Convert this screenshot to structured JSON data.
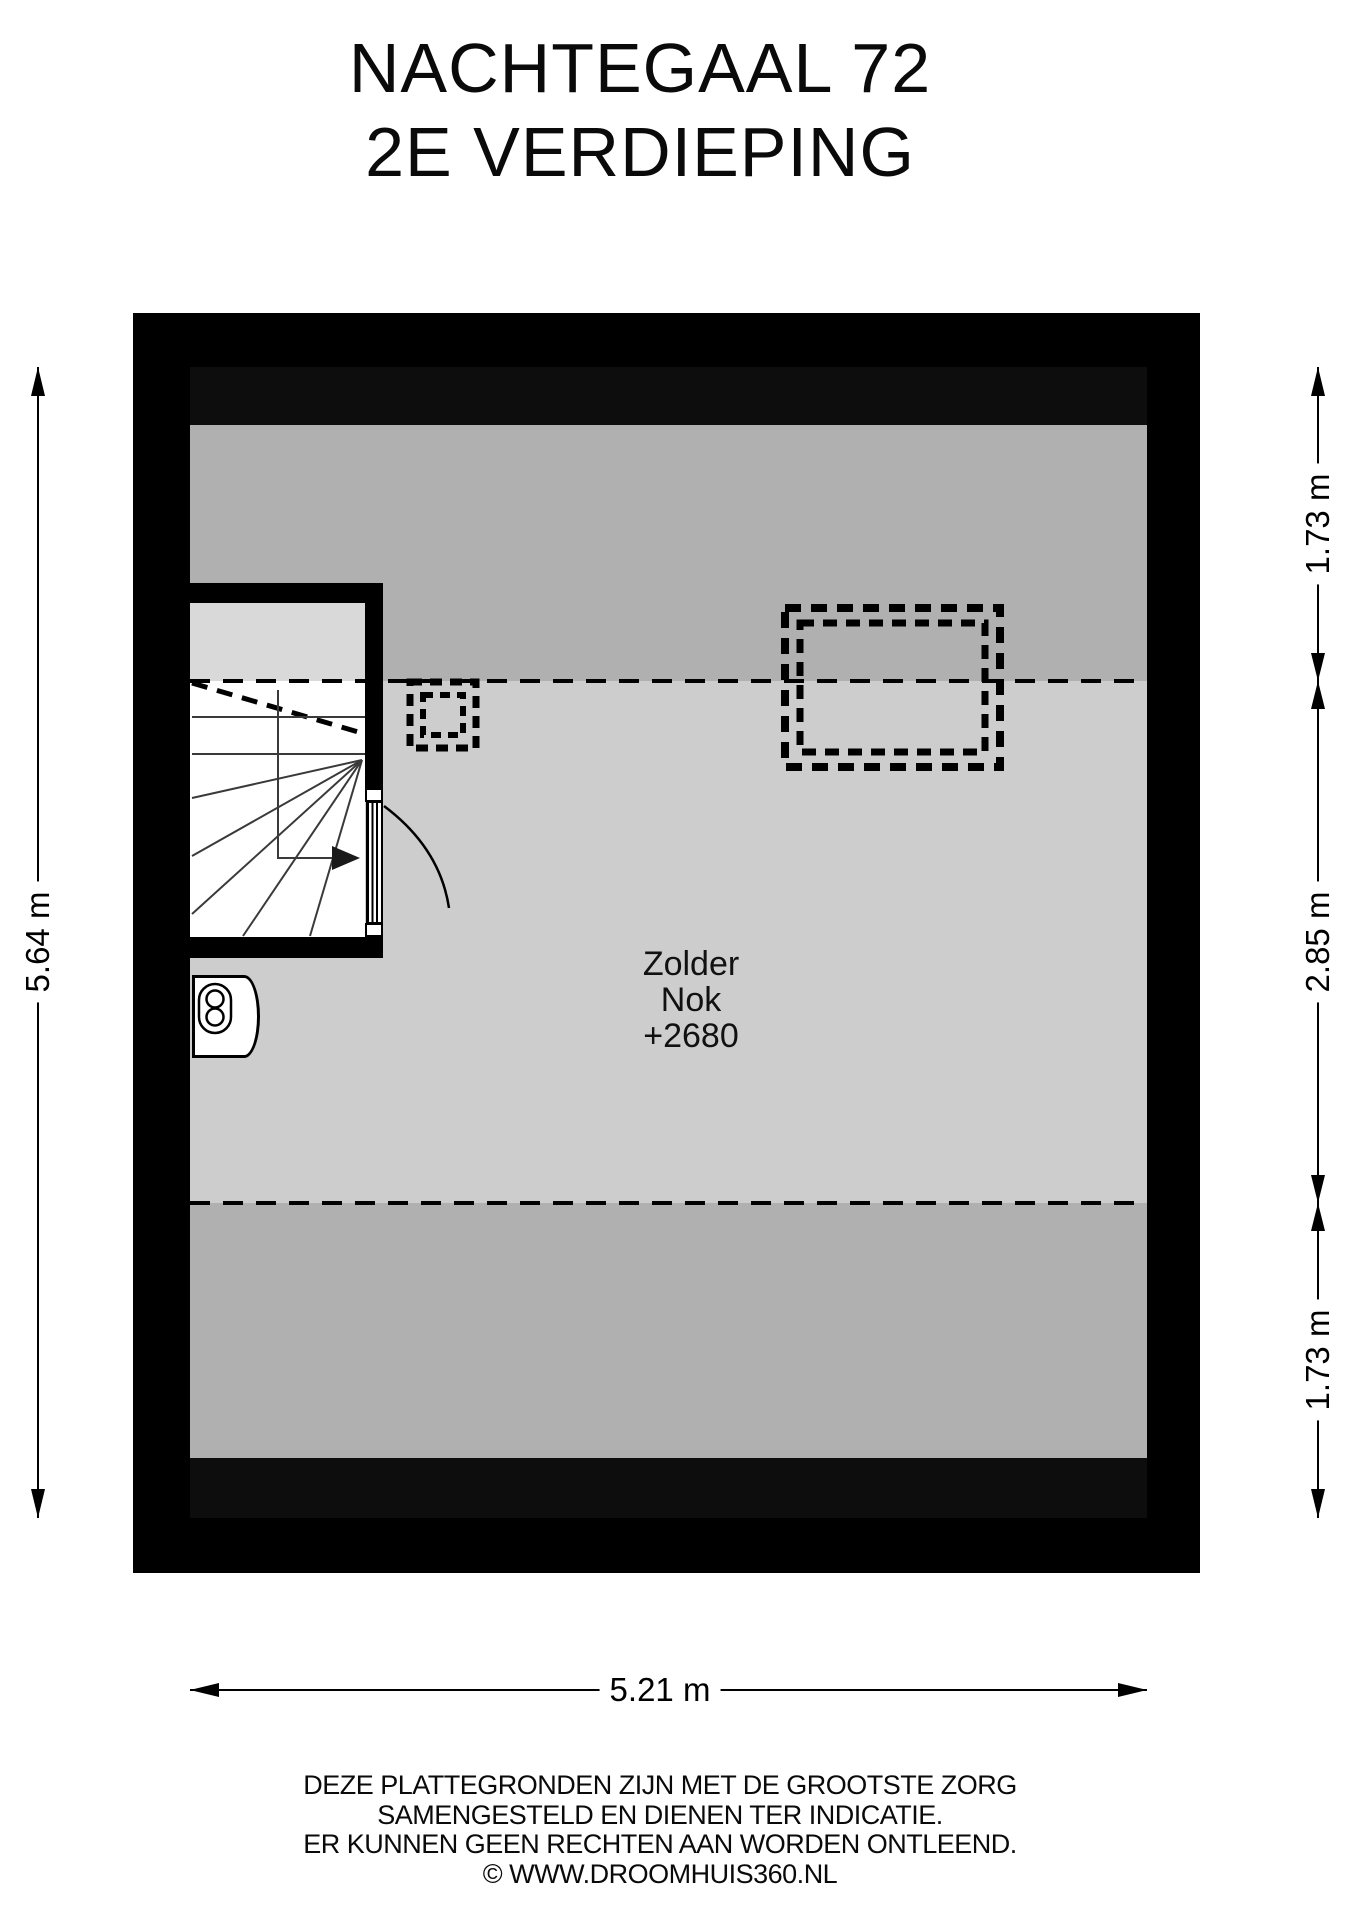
{
  "title": {
    "line1": "NACHTEGAAL 72",
    "line2": "2E VERDIEPING"
  },
  "room": {
    "name": "Zolder",
    "ridge_label": "Nok",
    "ridge_height": "+2680"
  },
  "dimensions": {
    "left_height": "5.64 m",
    "right_top": "1.73 m",
    "right_middle": "2.85 m",
    "right_bottom": "1.73 m",
    "bottom_width": "5.21 m"
  },
  "footer": {
    "line1": "DEZE PLATTEGRONDEN ZIJN MET DE GROOTSTE ZORG",
    "line2": "SAMENGESTELD EN DIENEN TER INDICATIE.",
    "line3": "ER KUNNEN GEEN RECHTEN AAN WORDEN ONTLEEND.",
    "line4": "© WWW.DROOMHUIS360.NL"
  },
  "icons": {
    "boiler": "boiler-icon",
    "stair_direction": "stair-direction-arrow",
    "roof_window_small": "roof-window-small",
    "roof_window_large": "roof-window-large"
  },
  "colors": {
    "wall": "#000000",
    "low_headroom_band": "#0d0d0d",
    "zone_medium_gray": "#b0b0b0",
    "zone_light_gray": "#cdcdcd",
    "stair_upper_gray": "#d9d9d9",
    "lines": "#000000",
    "background": "#ffffff"
  }
}
